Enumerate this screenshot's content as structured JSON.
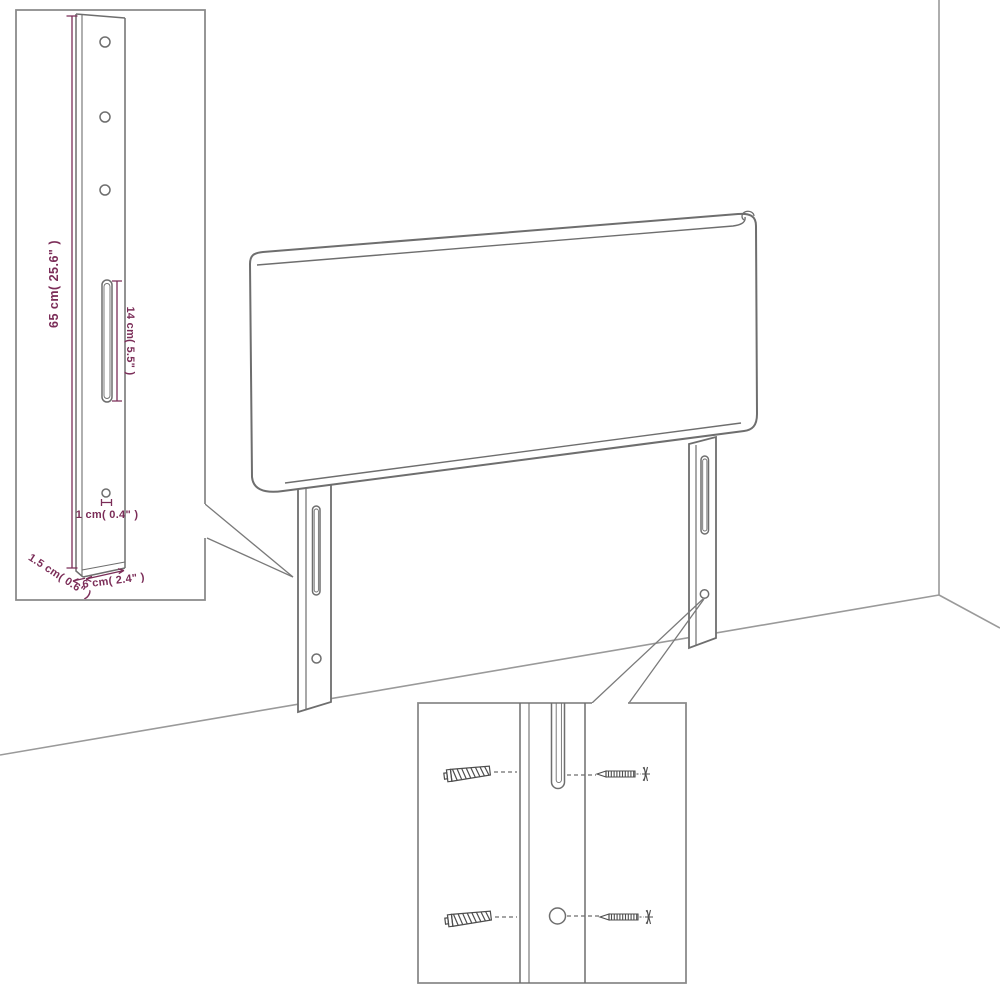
{
  "diagram": {
    "type": "product-assembly-dimension-diagram",
    "subject": "bed headboard with two mounting legs in room corner",
    "colors": {
      "background": "#ffffff",
      "outline_gray": "#6e6e6e",
      "inset_border_gray": "#8a8a8a",
      "room_line_gray": "#9a9a9a",
      "dimension_magenta": "#7b2d58",
      "screw_dark": "#4d4d4d"
    },
    "insets": {
      "bracket_detail": {
        "description": "close-up of mounting leg bracket with holes and slot",
        "dimensions": {
          "height": "65 cm( 25.6\" )",
          "slot": "14 cm( 5.5\" )",
          "hole": "1 cm( 0.4\" )",
          "depth": "1.5 cm( 0.6\" )",
          "width": "6 cm( 2.4\" )"
        }
      },
      "screw_detail": {
        "description": "close-up of leg slot and hole with screws"
      }
    }
  }
}
